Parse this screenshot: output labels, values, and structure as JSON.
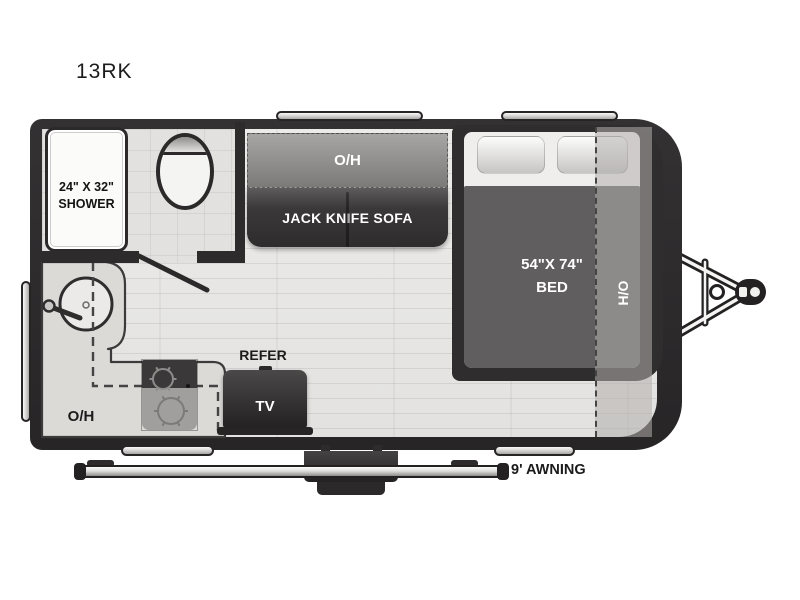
{
  "title": "13RK",
  "labels": {
    "shower_size": "24\" X 32\"",
    "shower": "SHOWER",
    "sofa_overhead": "O/H",
    "sofa": "JACK KNIFE SOFA",
    "bed_size": "54\"X 74\"",
    "bed": "BED",
    "bed_side": "H/O",
    "kitchen_overhead": "O/H",
    "refrigerator": "REFER",
    "tv": "TV",
    "awning": "9' AWNING"
  },
  "colors": {
    "wall": "#2d2b2c",
    "floor": "#e8e7e5",
    "overhead_cabinet": "#8f8d8c",
    "sofa": "#323031",
    "bed_blanket": "#605e5f",
    "fixture_white": "#fbfbfa",
    "label_text": "#1b1b1b",
    "label_text_light": "#ffffff"
  }
}
